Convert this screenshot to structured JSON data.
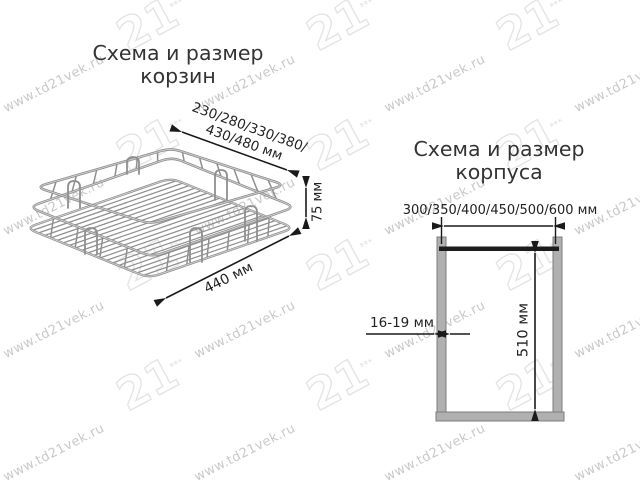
{
  "watermark": {
    "url_text": "www.td21vek.ru",
    "logo_text": "21",
    "logo_sub_text": "век"
  },
  "left_diagram": {
    "title_line1": "Схема и размер",
    "title_line2": "корзин",
    "width_dim_line1": "230/280/330/380/",
    "width_dim_line2": "430/480 мм",
    "height_dim": "75 мм",
    "depth_dim": "440 мм"
  },
  "right_diagram": {
    "title_line1": "Схема и размер",
    "title_line2": "корпуса",
    "width_dim": "300/350/400/450/500/600 мм",
    "height_dim": "510 мм",
    "thickness_dim": "16-19 мм"
  },
  "colors": {
    "wire": "#8f8f8f",
    "wire_highlight": "#d2d2d2",
    "dim_line": "#1a1a1a",
    "panel_fill": "#b0b0b0",
    "panel_border": "#7d7d7d",
    "top_bar": "#1c1c1c",
    "text": "#333333",
    "watermark_text": "#c9c9c9",
    "watermark_logo_outline": "#e3e3e3"
  }
}
